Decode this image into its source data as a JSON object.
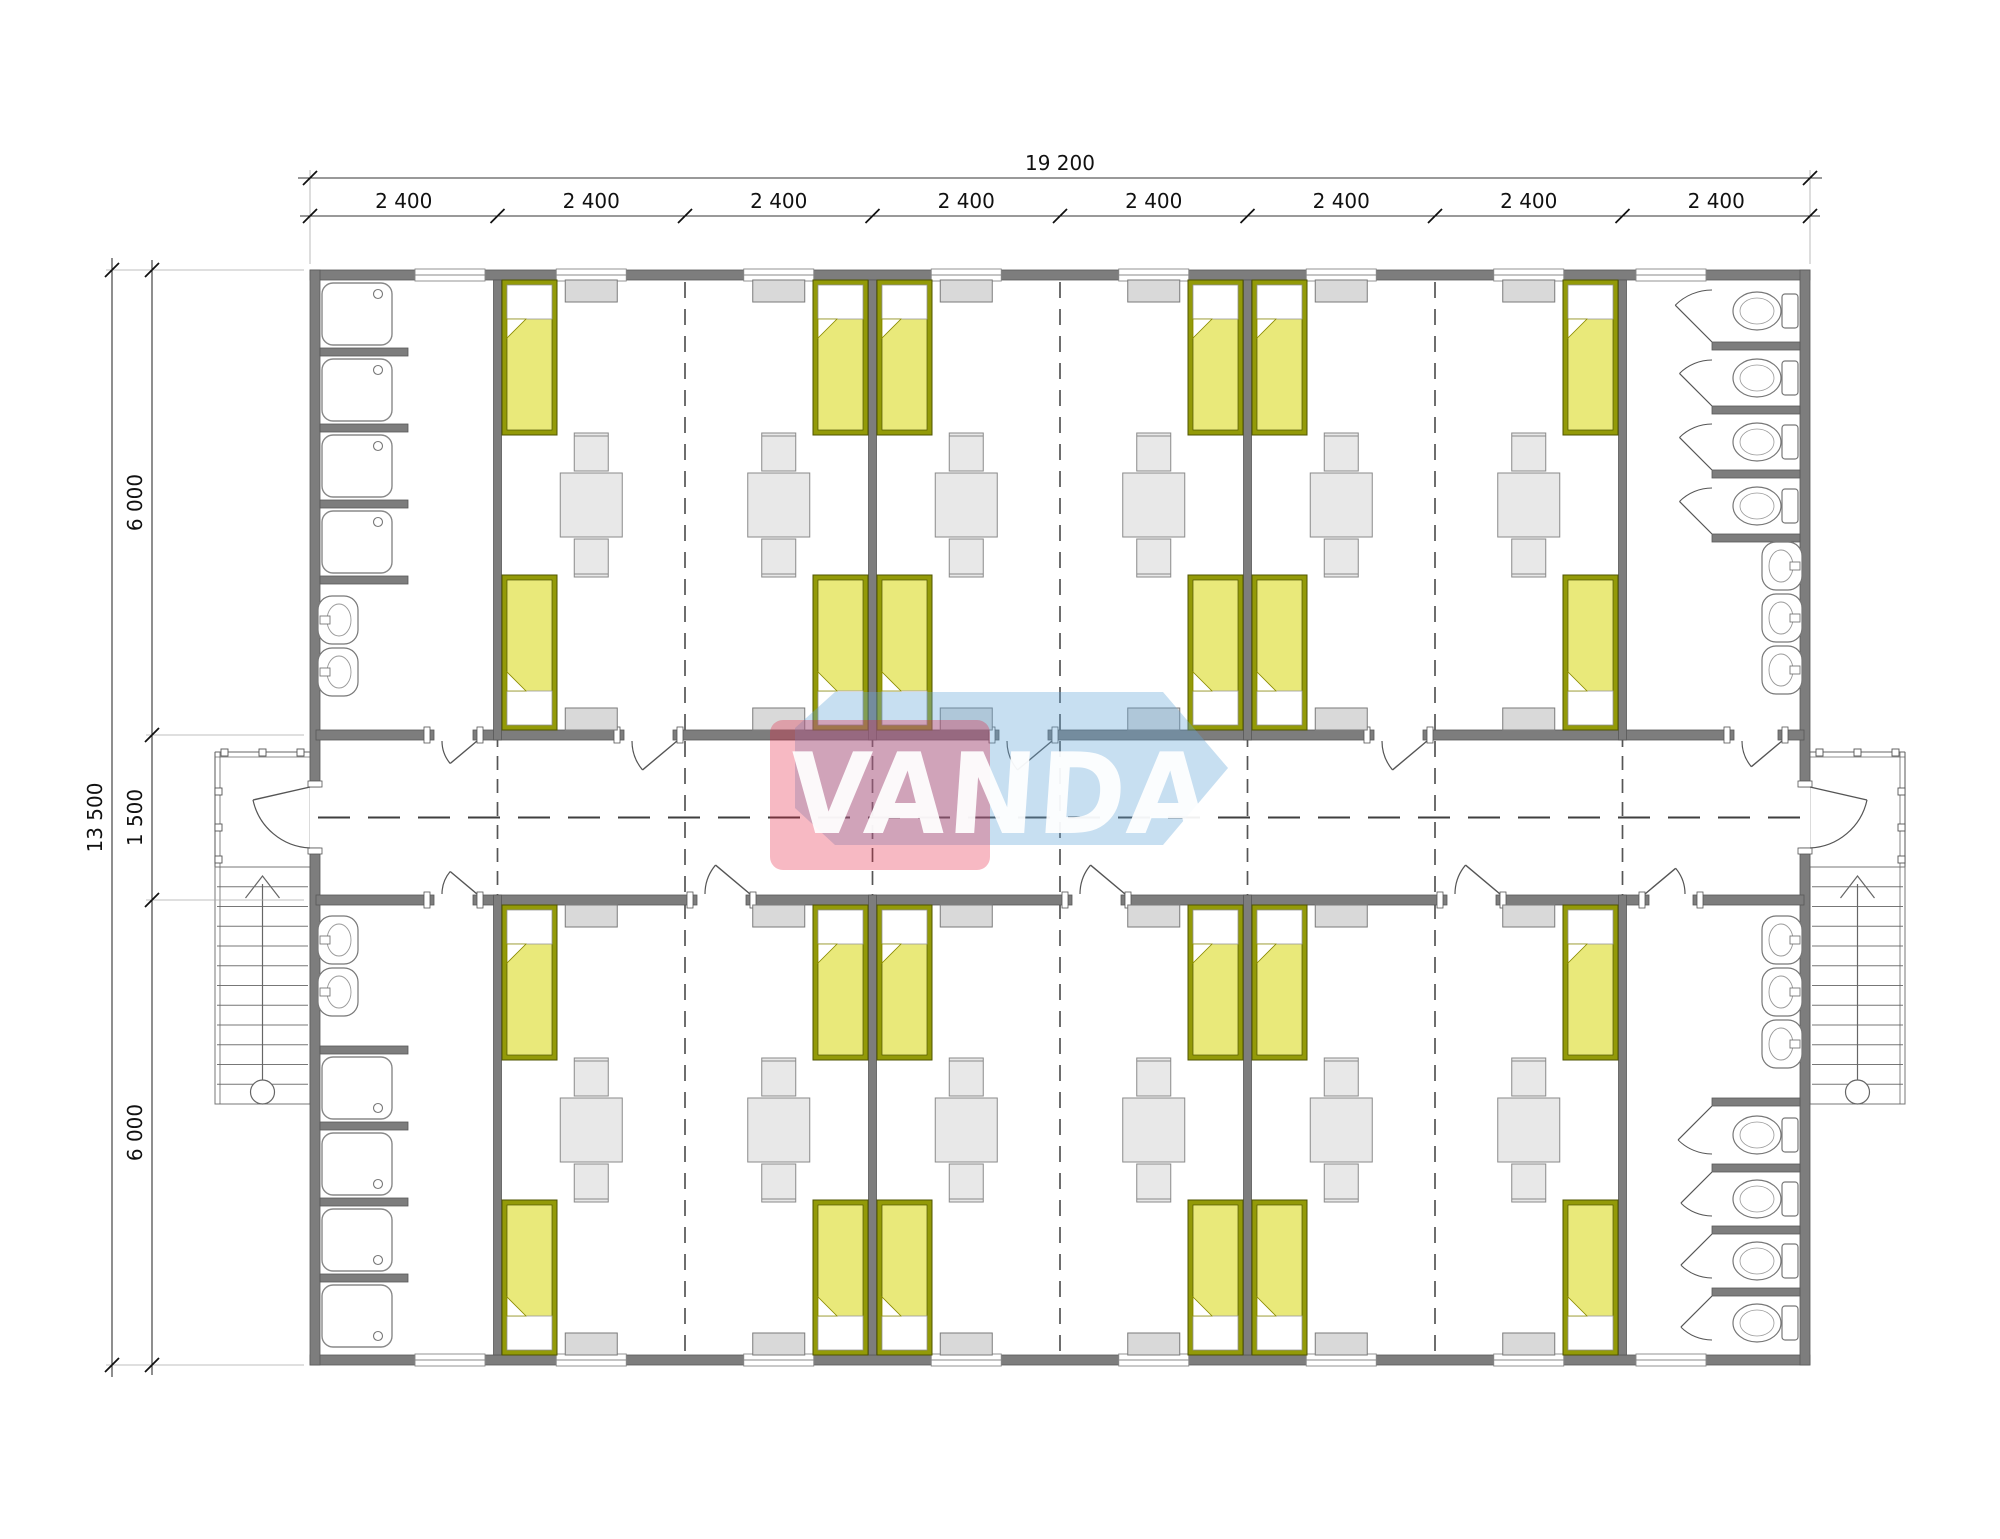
{
  "watermark": {
    "text": "VANDA",
    "red_color": "rgba(230,30,60,0.31)",
    "blue_color": "rgba(100,165,215,0.36)",
    "text_color": "rgba(255,255,255,0.93)"
  },
  "dimensions": {
    "top_total": {
      "label": "19 200"
    },
    "top_segments": {
      "label": "2 400",
      "count": 8
    },
    "left_total": {
      "label": "13 500"
    },
    "left_segments": [
      "6 000",
      "1 500",
      "6 000"
    ]
  },
  "colors": {
    "wall_fill": "#7d7d7d",
    "wall_stroke": "#585858",
    "bed_frame": "#939a08",
    "bed_frame_stroke": "#4f5400",
    "bed_blanket": "#e9e97a",
    "pillow_fill": "#ffffff",
    "furniture_fill": "#e8e8e8",
    "furniture_stroke": "#8a8a8a",
    "cabinet_fill": "#d9d9d9",
    "cabinet_stroke": "#7a7a7a",
    "fixture_stroke": "#777777",
    "door_stroke": "#555555",
    "dash_stroke": "#555555",
    "centerline_stroke": "#3f3f3f",
    "stair_stroke": "#666666",
    "dim_line": "#333333",
    "dim_tick": "#111111",
    "dim_text": "#111111"
  },
  "plan": {
    "canvas": [
      2000,
      1539
    ],
    "building": {
      "x": 310,
      "y": 270,
      "w": 1500,
      "h": 1095,
      "wall": 10
    },
    "module_w": 187.5,
    "module_count": 8,
    "corridor": {
      "top_wall_y": 730,
      "bottom_wall_y": 895,
      "wall": 10,
      "centerline_y": 817.5
    },
    "divider_walls": [
      497.5,
      872.5,
      1247.5,
      1622.5
    ],
    "joint_lines": [
      685,
      1060,
      1435
    ],
    "room_module_centers": [
      591.25,
      778.75,
      966.25,
      1153.75,
      1341.25,
      1528.75
    ],
    "window_centers": [
      450,
      591.25,
      778.75,
      966.25,
      1153.75,
      1341.25,
      1528.75,
      1671
    ],
    "window_w": 70,
    "corridor_wall_segments_top": [
      [
        320,
        430
      ],
      [
        477,
        620
      ],
      [
        677,
        995
      ],
      [
        1052,
        1370
      ],
      [
        1427,
        1730
      ],
      [
        1782,
        1800
      ]
    ],
    "corridor_wall_segments_bottom": [
      [
        320,
        430
      ],
      [
        477,
        693
      ],
      [
        750,
        1068
      ],
      [
        1125,
        1443
      ],
      [
        1500,
        1645
      ],
      [
        1697,
        1800
      ]
    ],
    "doors_top": [
      [
        430,
        477,
        "R"
      ],
      [
        620,
        677,
        "R"
      ],
      [
        995,
        1052,
        "R"
      ],
      [
        1370,
        1427,
        "R"
      ],
      [
        1730,
        1782,
        "R"
      ]
    ],
    "doors_bottom": [
      [
        430,
        477,
        "R"
      ],
      [
        693,
        750,
        "R"
      ],
      [
        1068,
        1125,
        "R"
      ],
      [
        1443,
        1500,
        "R"
      ],
      [
        1645,
        1697,
        "L"
      ]
    ],
    "exit_door": {
      "y1": 787,
      "y2": 848
    },
    "bed": {
      "w": 55,
      "l": 155,
      "top_band_y": [
        280,
        575
      ],
      "bottom_band_y": [
        905,
        1200
      ]
    },
    "table_center_y": [
      505,
      1130
    ],
    "cabinet": {
      "w": 52,
      "h": 22,
      "rows_y": [
        280,
        708,
        905,
        1333
      ]
    },
    "sanitary": {
      "shower_stub_len": 88,
      "shower_stubs_top": [
        348,
        424,
        500,
        576
      ],
      "shower_stalls_top": [
        [
          280,
          348
        ],
        [
          356,
          424
        ],
        [
          432,
          500
        ],
        [
          508,
          576
        ]
      ],
      "shower_stubs_bottom": [
        1046,
        1122,
        1198,
        1274
      ],
      "shower_stalls_bottom": [
        [
          1054,
          1122
        ],
        [
          1130,
          1198
        ],
        [
          1206,
          1274
        ],
        [
          1282,
          1350
        ]
      ],
      "toilet_stub_len": 88,
      "toilet_stubs_top": [
        342,
        406,
        470,
        534
      ],
      "toilet_stalls_top": [
        [
          280,
          342
        ],
        [
          350,
          406
        ],
        [
          414,
          470
        ],
        [
          478,
          534
        ]
      ],
      "toilet_stubs_bottom": [
        1098,
        1164,
        1226,
        1288
      ],
      "toilet_stalls_bottom": [
        [
          1106,
          1164
        ],
        [
          1172,
          1226
        ],
        [
          1234,
          1288
        ],
        [
          1296,
          1350
        ]
      ],
      "sinks_left_top_cy": [
        620,
        672
      ],
      "sinks_left_bottom_cy": [
        940,
        992
      ],
      "sinks_right_top_cy": [
        566,
        618,
        670
      ],
      "sinks_right_bottom_cy": [
        940,
        992,
        1044
      ],
      "showers_per_block": 4,
      "toilets_per_block": 4
    },
    "stairs": {
      "w": 95,
      "left_x": 215,
      "right_x": 1810,
      "landing_top": 752,
      "stairs_top": 867,
      "stairs_bottom": 1104,
      "tread_lines": 11
    },
    "dims_px": {
      "top_line1_y": 178,
      "top_line2_y": 216,
      "left_line1_x": 112,
      "left_line2_x": 152,
      "left_band_ticks": [
        270,
        735,
        900,
        1365
      ]
    }
  }
}
